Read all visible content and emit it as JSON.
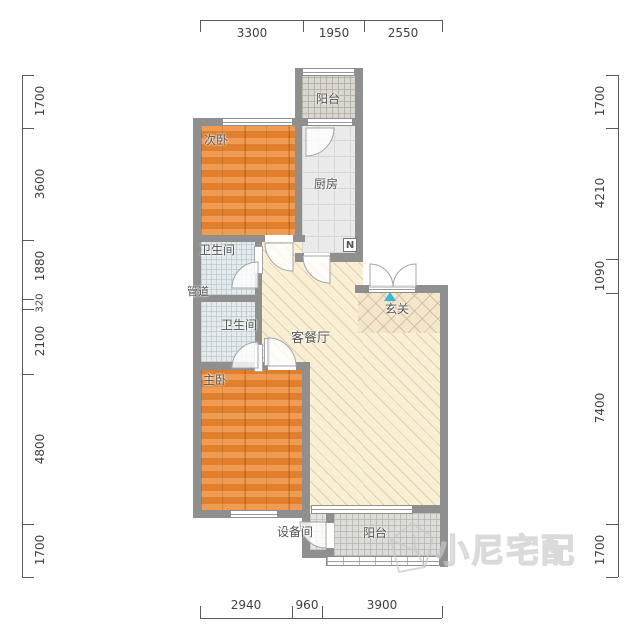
{
  "rooms": {
    "secondary_bedroom": "次卧",
    "balcony_top": "阳台",
    "kitchen": "厨房",
    "bathroom_top": "卫生间",
    "pipe_duct": "管道",
    "bathroom_bottom": "卫生间",
    "living_dining": "客餐厅",
    "entrance": "玄关",
    "master_bedroom": "主卧",
    "equipment_room": "设备间",
    "balcony_bottom": "阳台"
  },
  "dimensions": {
    "top": [
      "3300",
      "1950",
      "2550"
    ],
    "bottom": [
      "2940",
      "960",
      "3900"
    ],
    "left": [
      "1700",
      "3600",
      "1880",
      "320",
      "2100",
      "4800",
      "1700"
    ],
    "right": [
      "1700",
      "4210",
      "1090",
      "7400",
      "1700"
    ]
  },
  "symbols": {
    "kitchen_appliance": "N"
  },
  "watermark": {
    "text": "小尼宅配"
  },
  "colors": {
    "wall": "#8f8f8f",
    "wood_floor": "#e8893f",
    "living_floor": "#f8efd4",
    "kitchen_tile": "#eaeaea",
    "bath_tile": "#e4eaed",
    "balcony_tile": "#dcdcd8",
    "entrance_arrow": "#3ab6d8",
    "dimension_text": "#3f3f3f"
  }
}
